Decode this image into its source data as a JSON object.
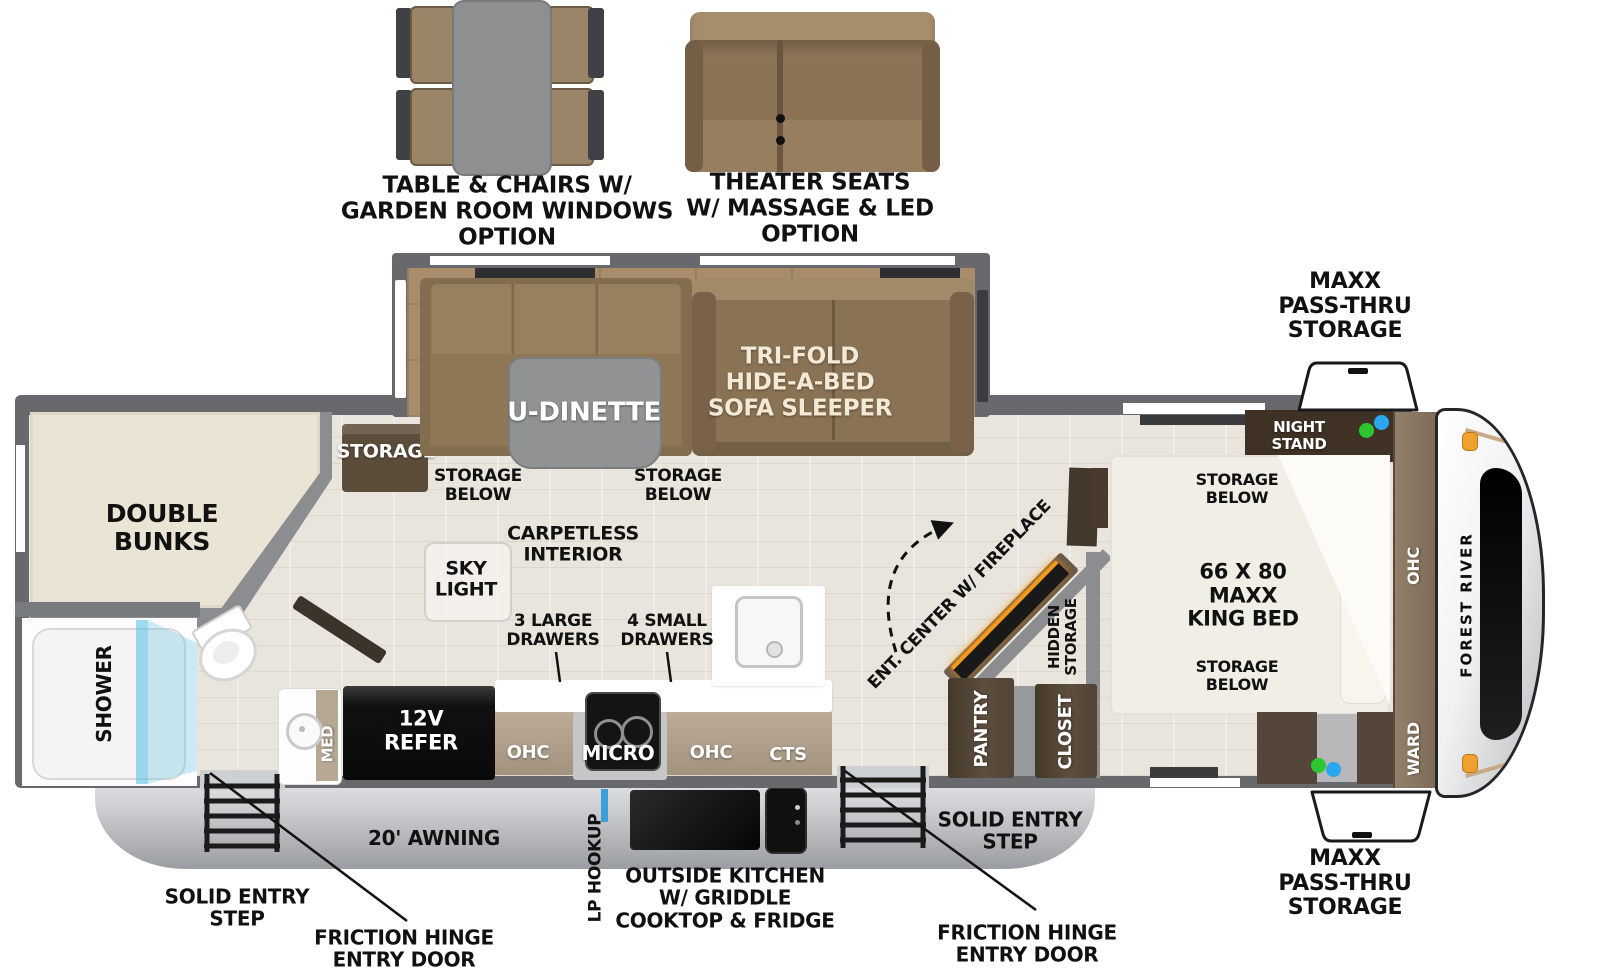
{
  "options": {
    "table_chairs_label": "TABLE & CHAIRS W/\nGARDEN ROOM WINDOWS\nOPTION",
    "theater_seats_label": "THEATER SEATS\nW/ MASSAGE & LED\nOPTION"
  },
  "exterior": {
    "passthru_front_top": "MAXX\nPASS-THRU\nSTORAGE",
    "passthru_front_bottom": "MAXX\nPASS-THRU\nSTORAGE",
    "awning": "20' AWNING",
    "lp_hookup": "LP HOOKUP",
    "outside_kitchen": "OUTSIDE KITCHEN\nW/ GRIDDLE\nCOOKTOP & FRIDGE",
    "entry_step_rear": "SOLID ENTRY\nSTEP",
    "entry_door_rear": "FRICTION HINGE\nENTRY DOOR",
    "entry_step_main": "SOLID ENTRY\nSTEP",
    "entry_door_main": "FRICTION HINGE\nENTRY DOOR",
    "brand": "FOREST RIVER"
  },
  "slide_out": {
    "u_dinette": "U-DINETTE",
    "sofa": "TRI-FOLD\nHIDE-A-BED\nSOFA SLEEPER",
    "storage": "STORAGE",
    "storage_below_left": "STORAGE\nBELOW",
    "storage_below_right": "STORAGE\nBELOW"
  },
  "living": {
    "carpetless": "CARPETLESS\nINTERIOR",
    "sky_light": "SKY\nLIGHT",
    "ent_center": "ENT. CENTER\nW/ FIREPLACE",
    "hidden_storage": "HIDDEN\nSTORAGE",
    "pantry": "PANTRY",
    "closet": "CLOSET"
  },
  "kitchen": {
    "drawers_large": "3 LARGE\nDRAWERS",
    "drawers_small": "4 SMALL\nDRAWERS",
    "ohc_left": "OHC",
    "micro": "MICRO",
    "ohc_right": "OHC",
    "cts": "CTS",
    "refer": "12V\nREFER"
  },
  "bath": {
    "shower": "SHOWER",
    "med": "MED"
  },
  "bunk_room": {
    "double_bunks": "DOUBLE\nBUNKS"
  },
  "bedroom": {
    "night_stand": "NIGHT\nSTAND",
    "storage_below_top": "STORAGE\nBELOW",
    "king_bed": "66 X 80\nMAXX\nKING BED",
    "storage_below_bottom": "STORAGE\nBELOW",
    "ohc": "OHC",
    "ward": "WARD"
  },
  "colors": {
    "wall": "#67696d",
    "floor": "#e9e5dc",
    "slide_floor": "#a98c6b",
    "wood_mid": "#8a7254",
    "wood_dark": "#54463a",
    "bunk_beige": "#e9e4d3",
    "counter_white": "#ffffff",
    "cabinet_band": "#b3a38e",
    "glass_blue": "#62c4e6",
    "fireplace_glow": "#f59a1b",
    "skirt_gray": "#c6c8ca",
    "dot_green": "#2ec62e",
    "dot_blue": "#2aa7ef",
    "marker_orange": "#f0a030"
  }
}
